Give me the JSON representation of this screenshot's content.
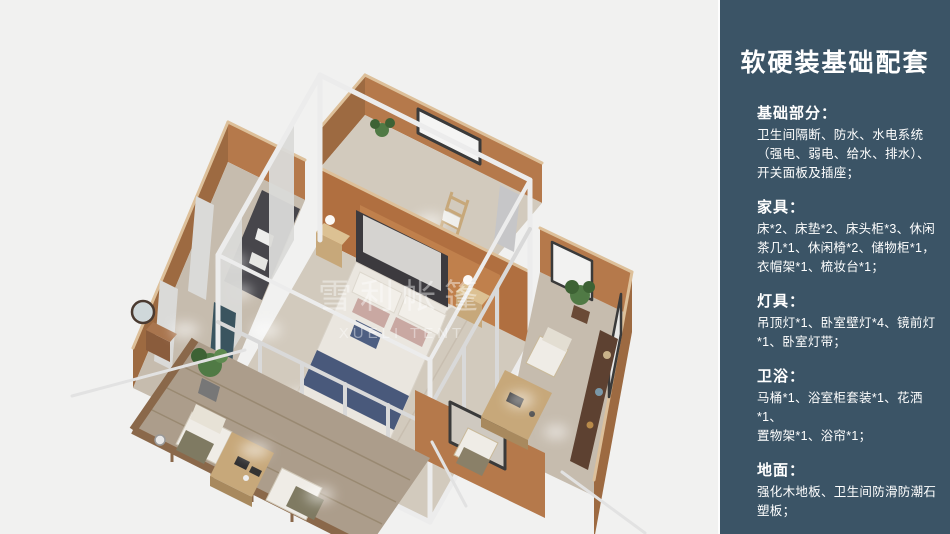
{
  "palette": {
    "page-bg": "#f1f1f0",
    "sidebar-bg": "#3b5466",
    "sidebar-text": "#ffffff",
    "wall": "#b5794b",
    "wall-dark": "#9d6a41",
    "wall-face": "#b06f40",
    "wall-light": "#cf9257",
    "wall-top": "#ddc09a",
    "floor": "#d2cabd",
    "floor-dark": "#c6bcae",
    "deck": "#ac9d8b",
    "deck-dark": "#97876f",
    "rail": "#8a684a",
    "frame": "#ececec",
    "frame-dark": "#d9d9d9",
    "curtain": "#dadad8",
    "teal-curtain": "#3a545f",
    "duvet": "#eae6df",
    "bed-blue": "#49597b",
    "pillow": "#f2efe9",
    "mauve": "#c9a8a2",
    "headboard": "#3c3a3e",
    "dark-furniture": "#47464b",
    "wood": "#c7a87a",
    "wood-dark": "#a8895e",
    "sideboard": "#5d4131",
    "plant": "#507a45",
    "plant-dark": "#3d6234",
    "glow": "#ffffff",
    "window-trim": "#3a3a3a"
  },
  "illustration": {
    "watermark_cn": "雪利帐篷",
    "watermark_en": "XUELI TENT"
  },
  "sidebar": {
    "title": "软硬装基础配套",
    "sections": [
      {
        "heading": "基础部分：",
        "body": "卫生间隔断、防水、水电系统\n（强电、弱电、给水、排水）、\n开关面板及插座；"
      },
      {
        "heading": "家具：",
        "body": "床*2、床垫*2、床头柜*3、休闲\n茶几*1、休闲椅*2、储物柜*1，\n衣帽架*1、梳妆台*1；"
      },
      {
        "heading": "灯具：",
        "body": "吊顶灯*1、卧室壁灯*4、镜前灯\n*1、卧室灯带；"
      },
      {
        "heading": "卫浴：",
        "body": "马桶*1、浴室柜套装*1、花洒*1、\n置物架*1、浴帘*1；"
      },
      {
        "heading": "地面：",
        "body": "强化木地板、卫生间防滑防潮石\n塑板；"
      }
    ]
  }
}
